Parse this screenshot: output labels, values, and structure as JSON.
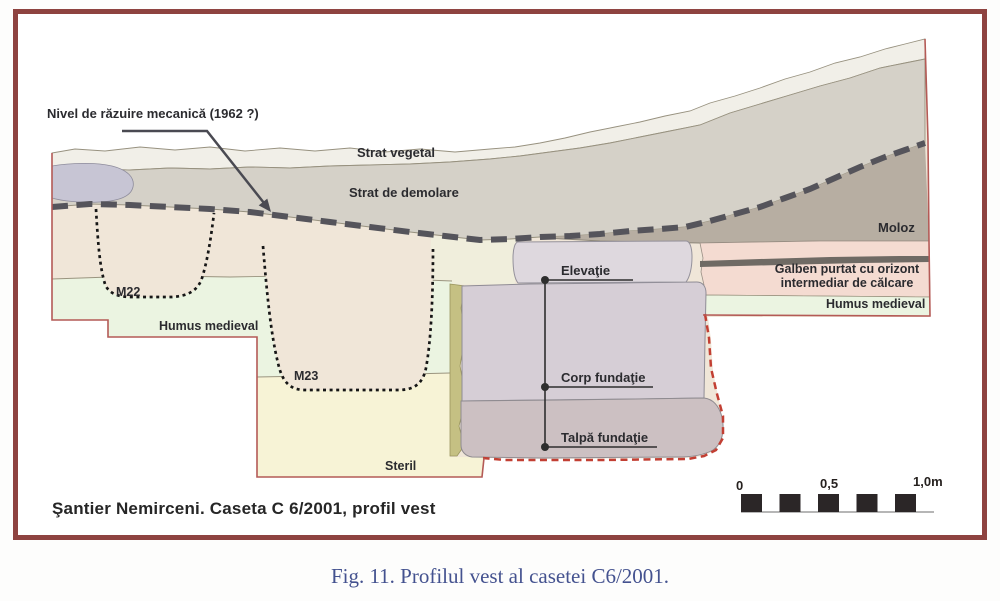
{
  "figure": {
    "title": "Şantier Nemirceni. Caseta C 6/2001,  profil vest",
    "caption": "Fig. 11.  Profilul vest al casetei C6/2001."
  },
  "labels": {
    "nivel_razuire": "Nivel de răzuire mecanică (1962 ?)",
    "strat_vegetal": "Strat vegetal",
    "strat_demolare": "Strat de demolare",
    "moloz": "Moloz",
    "galben_line1": "Galben purtat cu orizont",
    "galben_line2": "intermediar de călcare",
    "humus_medieval_right": "Humus medieval",
    "humus_medieval_left": "Humus medieval",
    "m22": "M22",
    "m23": "M23",
    "steril": "Steril",
    "elevatie": "Elevaţie",
    "corp_fundatie": "Corp fundaţie",
    "talpa_fundatie": "Talpă fundaţie"
  },
  "scale_bar": {
    "tick_0": "0",
    "tick_05": "0,5",
    "tick_10": "1,0m"
  },
  "colors": {
    "frame_border": "#8e4340",
    "profile_outline": "#b45a56",
    "strat_vegetal": "#f1efe8",
    "strat_demolare": "#d5d1c8",
    "demolare_blob": "#c7c5d4",
    "moloz": "#b7aea2",
    "strat_sub_razuire": "#f0e6d8",
    "pale_band": "#f0eedc",
    "humus_medieval": "#ebf4e1",
    "steril": "#f7f3d6",
    "galben_purtat": "#f4dbd1",
    "dark_band": "#6f6a64",
    "elevatie": "#ded8de",
    "corp_fundatie": "#d6ced6",
    "talpa_fundatie": "#ccc0c2",
    "mortar_strip": "#c5c083",
    "nivel_razuire_line": "#55545b",
    "foundation_dashed": "#c23f33",
    "caption_text": "#44528f",
    "scale_black": "#2b2627"
  }
}
